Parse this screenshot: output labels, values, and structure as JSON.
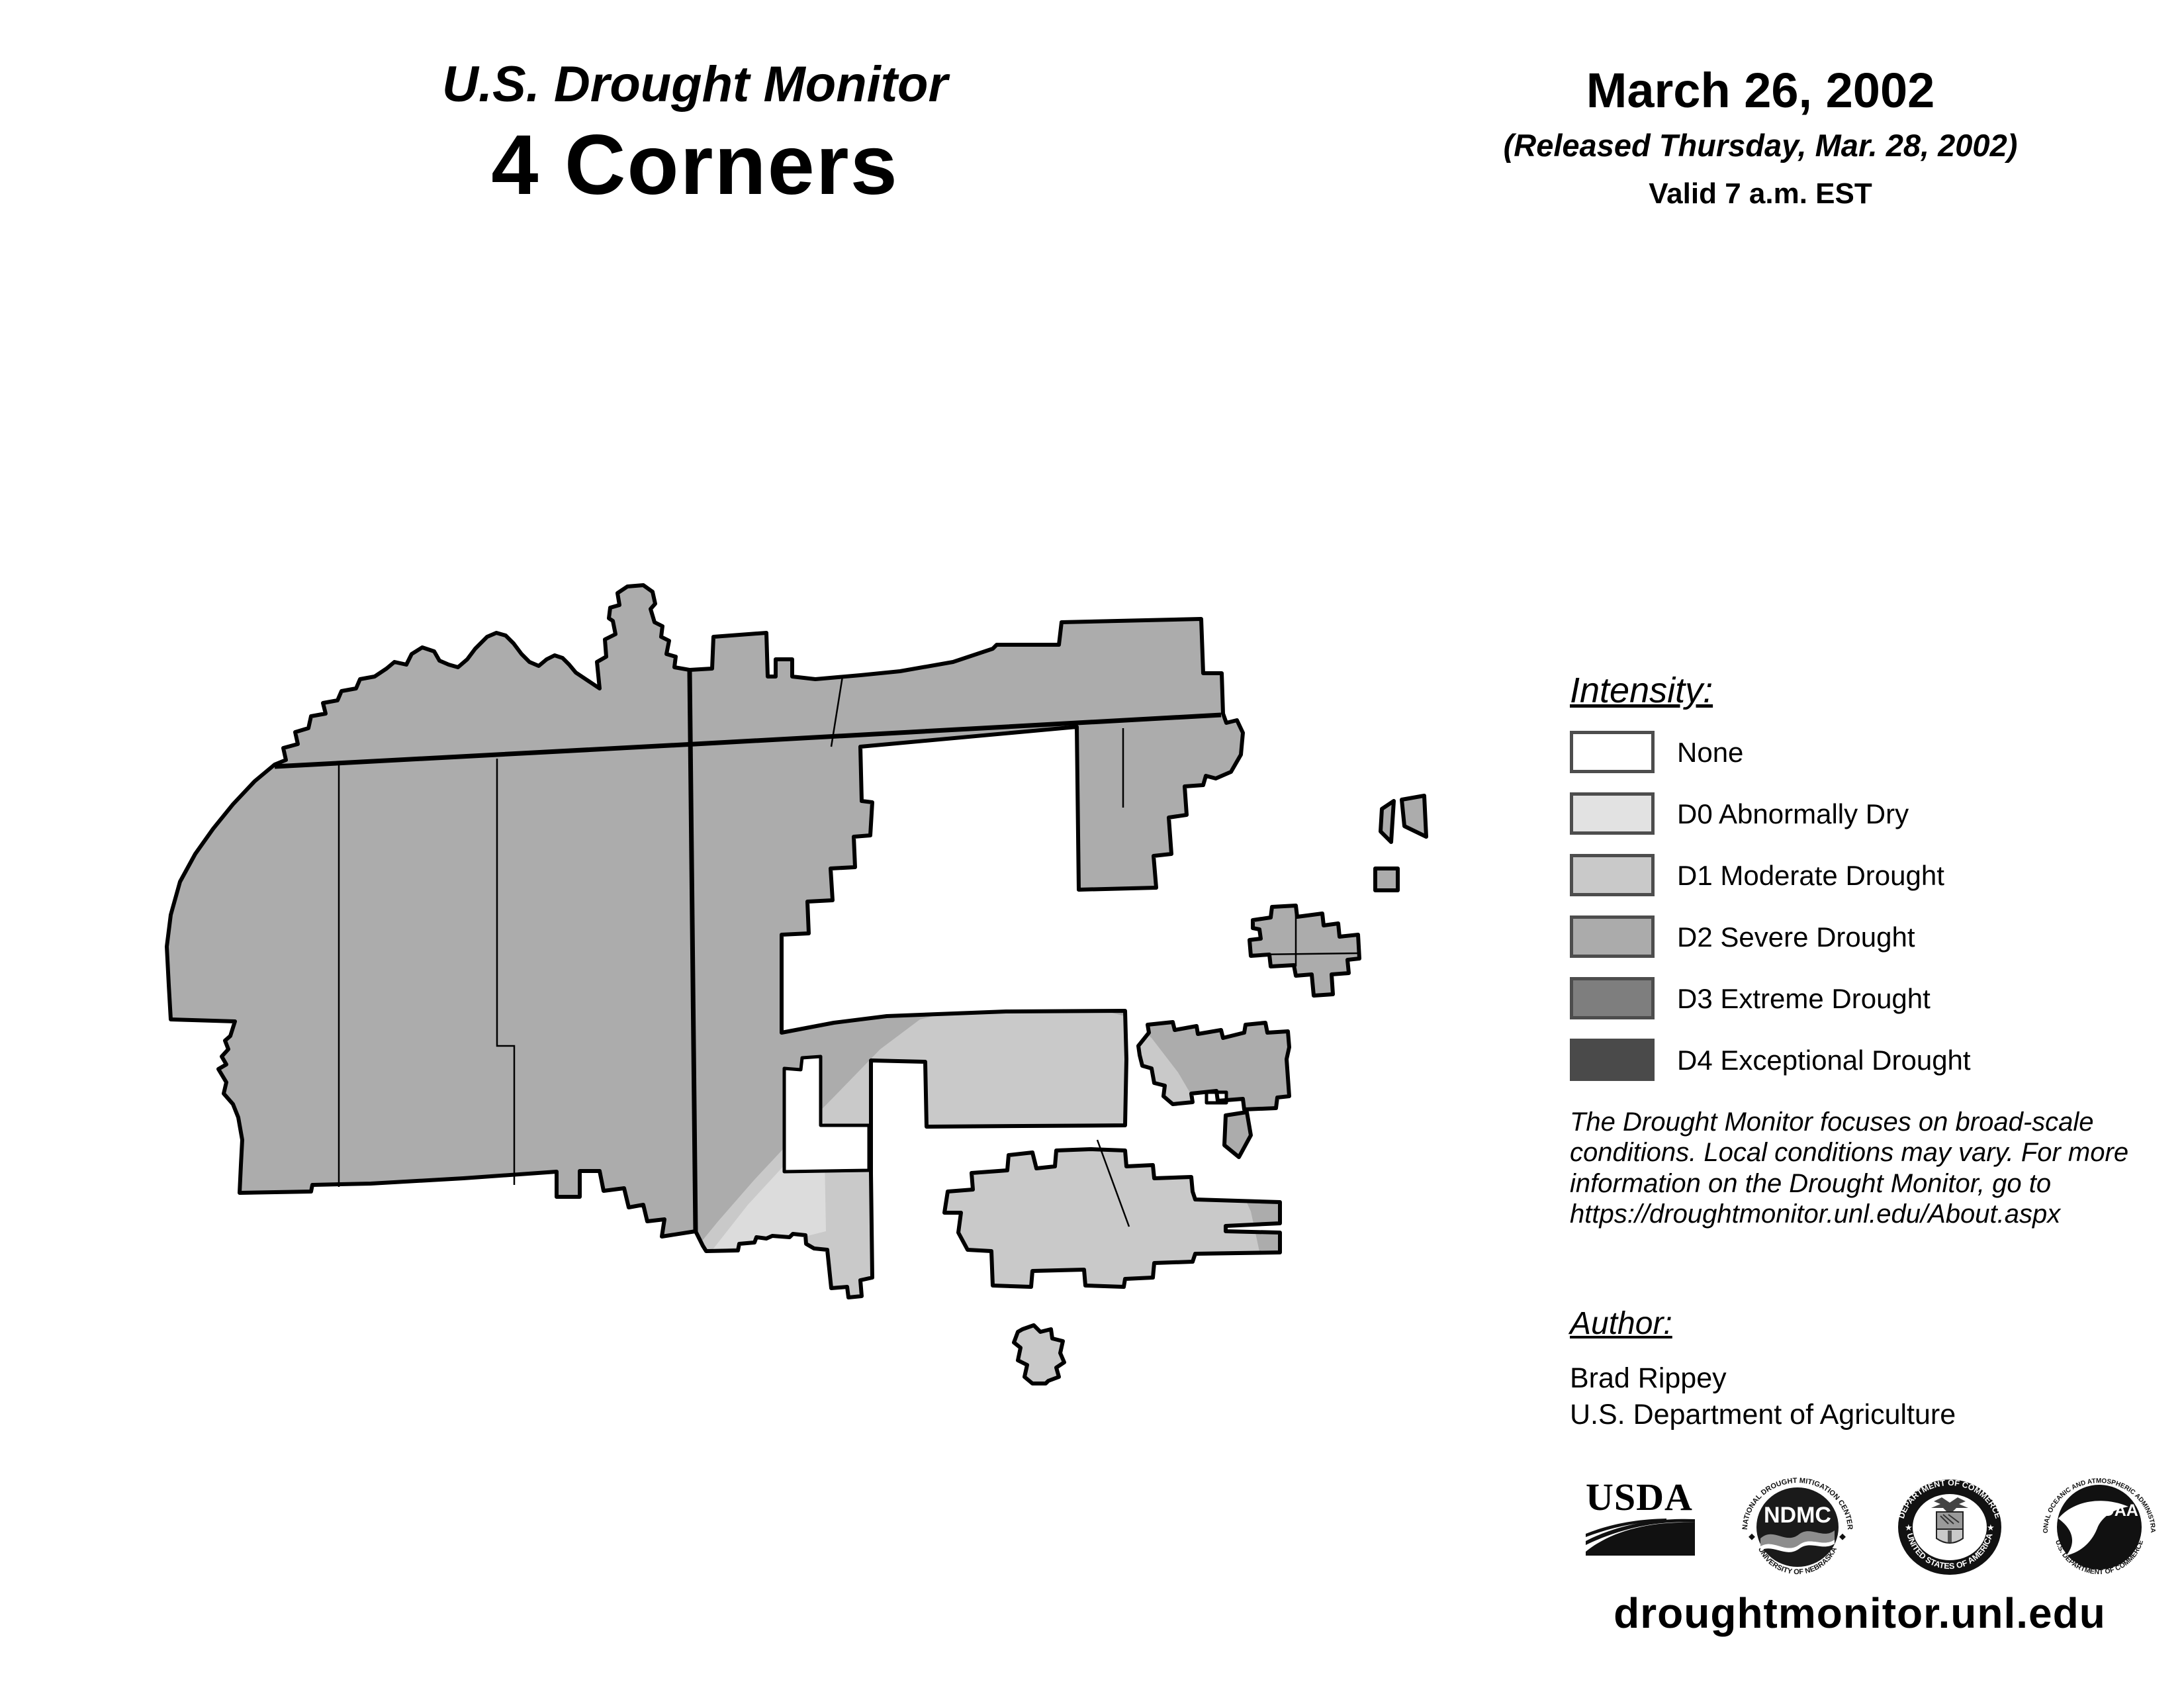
{
  "header": {
    "title": "U.S. Drought Monitor",
    "region": "4 Corners"
  },
  "date_block": {
    "date": "March 26, 2002",
    "released": "(Released Thursday, Mar. 28, 2002)",
    "valid": "Valid 7 a.m. EST"
  },
  "legend": {
    "heading": "Intensity:",
    "items": [
      {
        "label": "None",
        "color": "#ffffff"
      },
      {
        "label": "D0 Abnormally Dry",
        "color": "#e2e2e2"
      },
      {
        "label": "D1 Moderate Drought",
        "color": "#c9c9c9"
      },
      {
        "label": "D2 Severe Drought",
        "color": "#ababab"
      },
      {
        "label": "D3 Extreme Drought",
        "color": "#7e7e7e"
      },
      {
        "label": "D4 Exceptional Drought",
        "color": "#4a4a4a"
      }
    ]
  },
  "disclaimer": "The Drought Monitor focuses on broad-scale conditions. Local conditions may vary. For more information on the Drought Monitor, go to https://droughtmonitor.unl.edu/About.aspx",
  "author_block": {
    "heading": "Author:",
    "name": "Brad Rippey",
    "organization": "U.S. Department of Agriculture"
  },
  "logos": {
    "usda": "USDA",
    "ndmc": {
      "acronym": "NDMC",
      "ring_top": "NATIONAL DROUGHT MITIGATION CENTER",
      "ring_bottom": "UNIVERSITY OF NEBRASKA"
    },
    "doc": {
      "ring_top": "DEPARTMENT OF COMMERCE",
      "ring_bottom": "UNITED STATES OF AMERICA"
    },
    "noaa": {
      "acronym": "NOAA",
      "ring_top": "NATIONAL OCEANIC AND ATMOSPHERIC ADMINISTRATION",
      "ring_bottom": "U.S. DEPARTMENT OF COMMERCE"
    }
  },
  "footer": {
    "url": "droughtmonitor.unl.edu"
  },
  "map": {
    "description": "4 Corners region drought extent map",
    "dominant_category": "D2 Severe Drought",
    "colors": {
      "d2": "#acacac",
      "d1": "#c9c9c9",
      "d0": "#dcdcdc",
      "outline": "#000000",
      "none": "#ffffff"
    }
  }
}
